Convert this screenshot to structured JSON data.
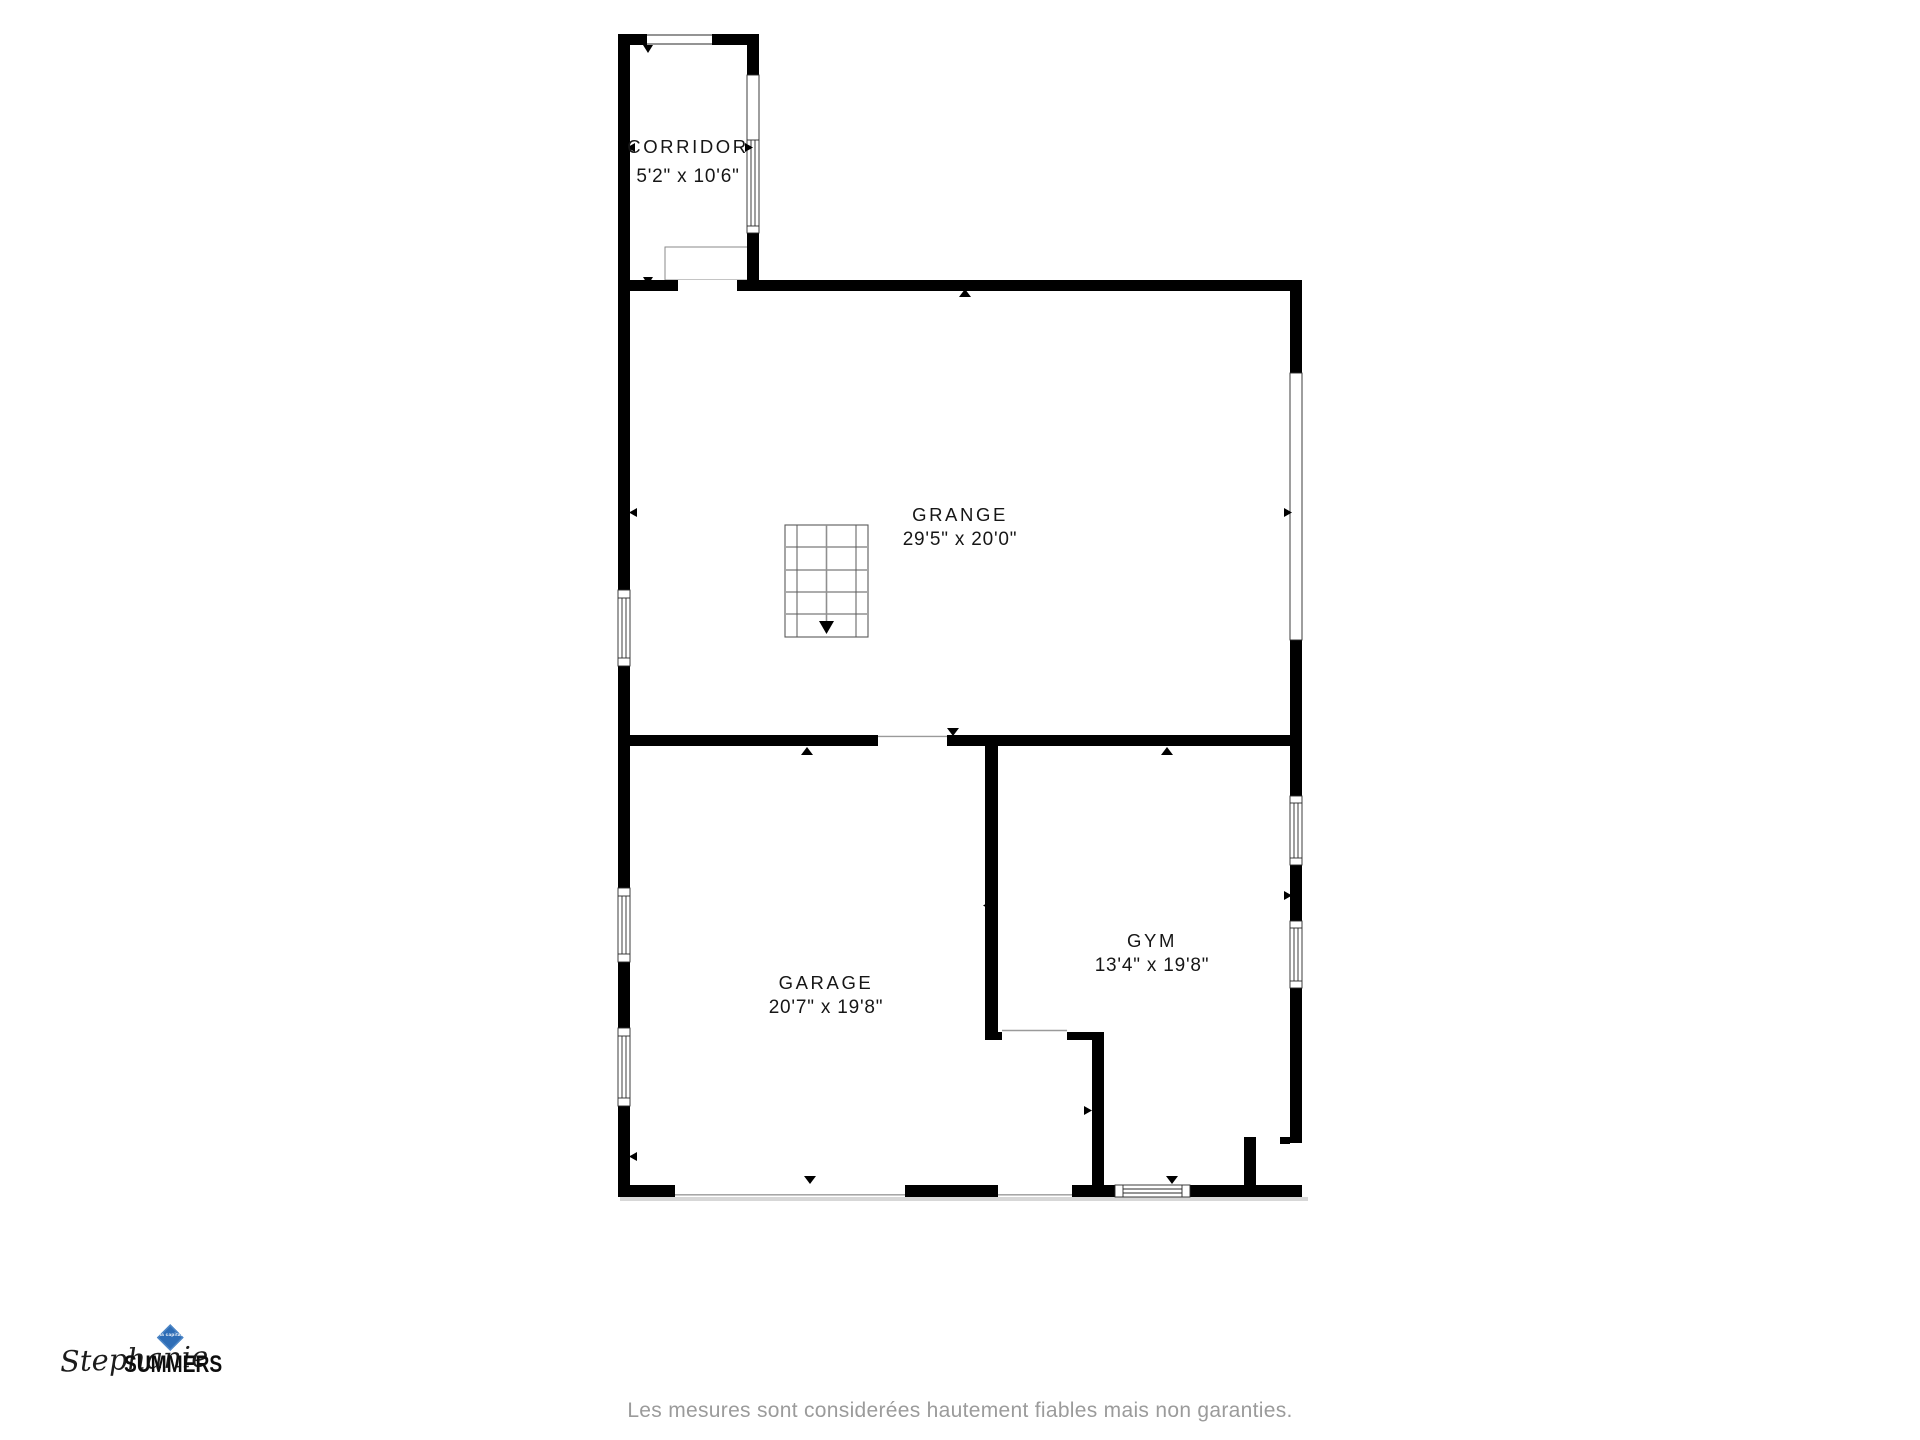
{
  "plan": {
    "rooms": [
      {
        "name": "CORRIDOR",
        "dims": "5'2\" x 10'6\""
      },
      {
        "name": "GRANGE",
        "dims": "29'5\" x 20'0\""
      },
      {
        "name": "GARAGE",
        "dims": "20'7\" x 19'8\""
      },
      {
        "name": "GYM",
        "dims": "13'4\" x 19'8\""
      }
    ]
  },
  "footer": {
    "disclaimer": "Les mesures sont considerées hautement fiables mais non garanties."
  },
  "logo": {
    "first_name": "Stephanie",
    "last_name": "SUMMERS",
    "brand": "via capitale"
  },
  "colors": {
    "wall_black": "#000000",
    "brand_blue": "#2e6db6",
    "disclaimer_gray": "#9b9b9b"
  }
}
